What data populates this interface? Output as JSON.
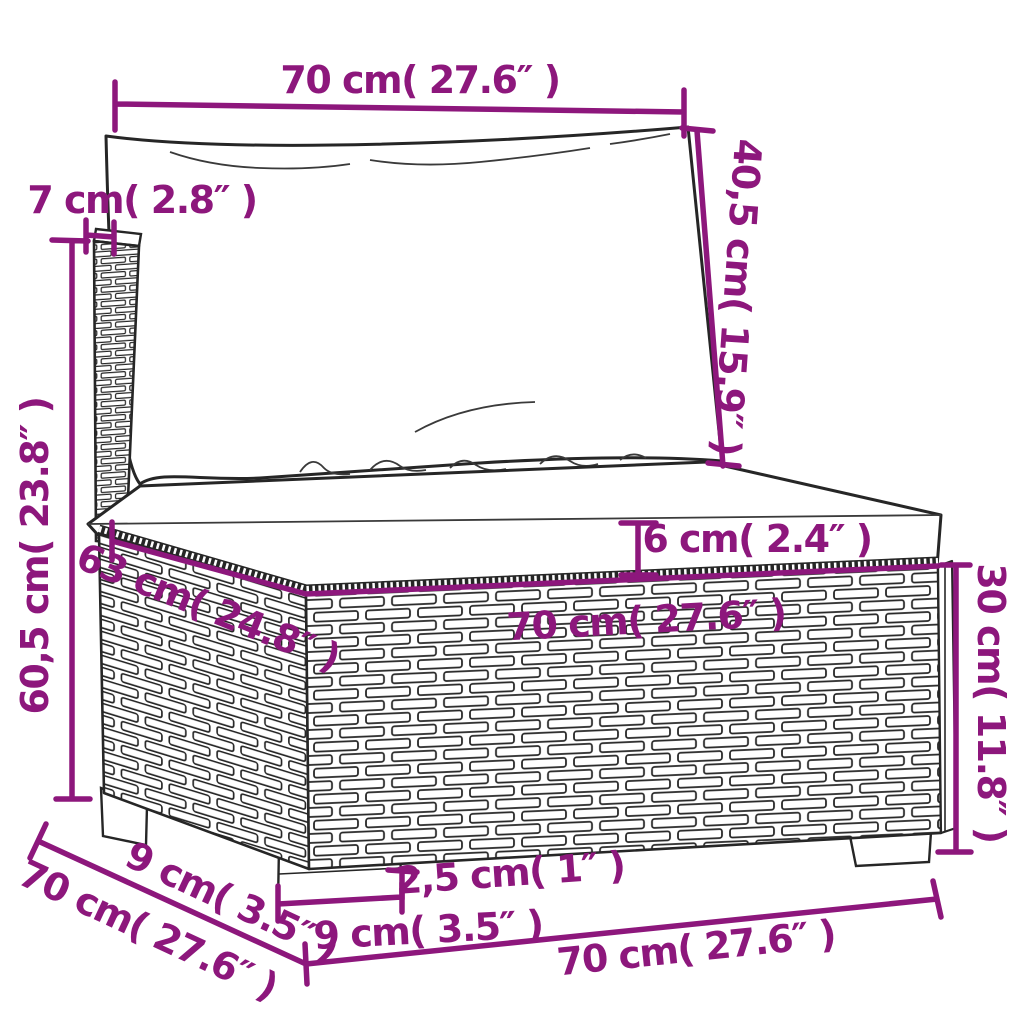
{
  "palette": {
    "background": "#ffffff",
    "dimension_color": "#8d177c",
    "line_art_color": "#262626"
  },
  "annotations": {
    "top_width": "70 cm( 27.6″ )",
    "backrest_thickness": "7 cm( 2.8″ )",
    "back_cushion_height": "40,5 cm( 15.9″ )",
    "overall_height": "60,5 cm( 23.8″ )",
    "seat_top_depth": "63 cm( 24.8″ )",
    "seat_cushion_thickness": "6 cm( 2.4″ )",
    "seat_top_width": "70 cm( 27.6″ )",
    "base_height": "30 cm( 11.8″ )",
    "foot_height": "2,5 cm( 1″ )",
    "leg_front_width": "9 cm( 3.5″ )",
    "leg_side_depth": "9 cm( 3.5″ )",
    "overall_depth": "70 cm( 27.6″ )",
    "overall_width": "70 cm( 27.6″ )"
  }
}
